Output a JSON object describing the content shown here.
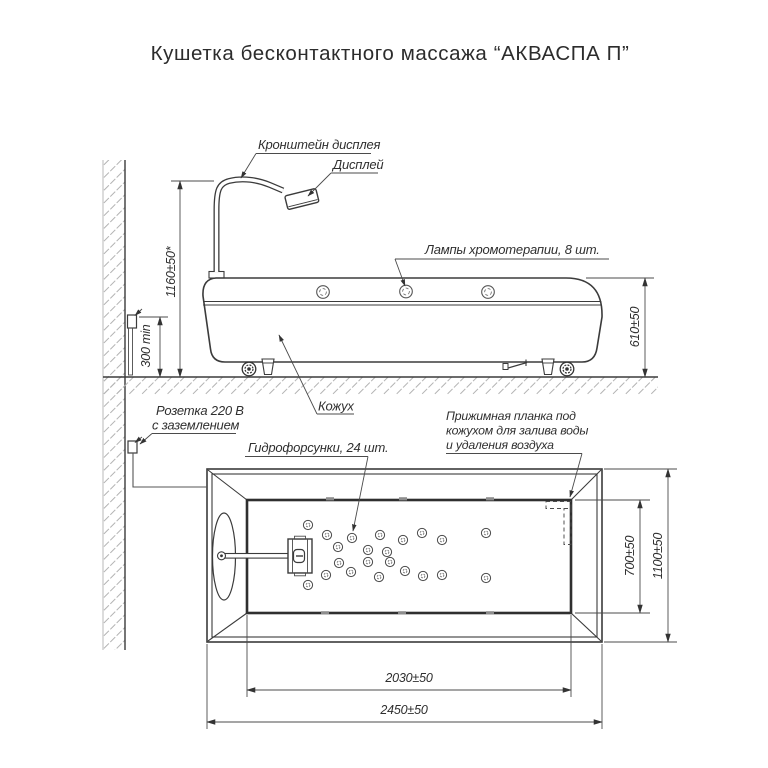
{
  "title": "Кушетка бесконтактного массажа “АКВАСПА П”",
  "side_view": {
    "labels": {
      "display_bracket": "Кронштейн дисплея",
      "display": "Дисплей",
      "lamps": "Лампы хромотерапии, 8 шт.",
      "cover": "Кожух",
      "socket_line1": "Розетка 220 В",
      "socket_line2": "с заземлением"
    },
    "dims": {
      "display_height": "1160±50*",
      "socket_height": "300 min",
      "couch_height": "610±50"
    }
  },
  "plan_view": {
    "labels": {
      "nozzles": "Гидрофорсунки, 24 шт.",
      "strip_line1": "Прижимная планка под",
      "strip_line2": "кожухом для залива воды",
      "strip_line3": "и удаления воздуха"
    },
    "dims": {
      "basin_width": "700±50",
      "overall_width": "1100±50",
      "basin_length": "2030±50",
      "overall_length": "2450±50"
    }
  }
}
